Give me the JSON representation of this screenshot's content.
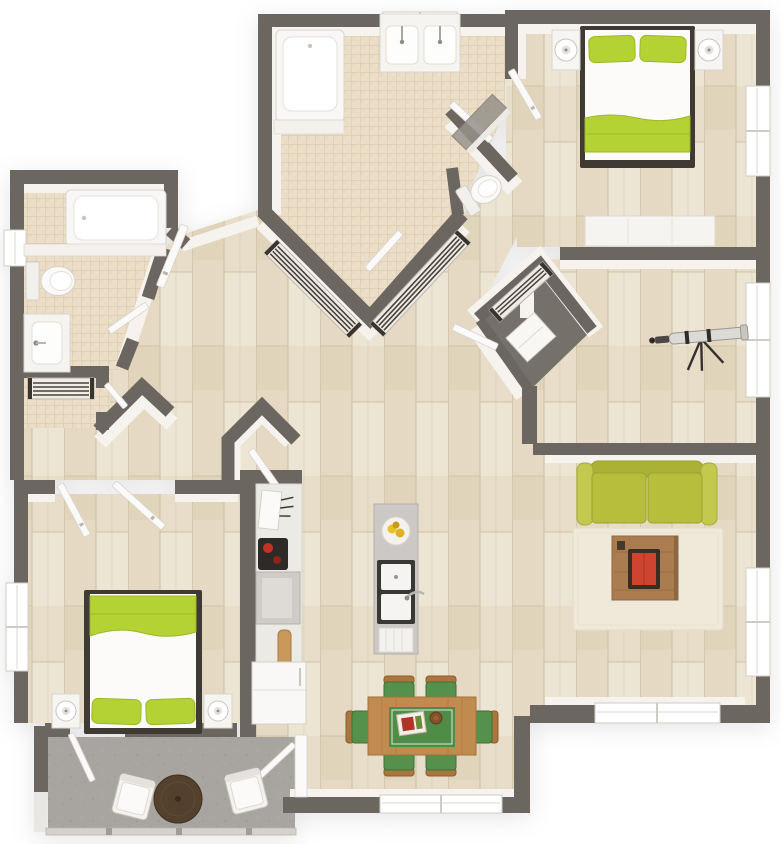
{
  "meta": {
    "description": "3D top-down floor plan of a two-bedroom two-bathroom apartment with open kitchen, dining area, living room, den with telescope, walk-in closets and a balcony patio"
  },
  "colors": {
    "background": "#ffffff",
    "wall": "#6c6660",
    "wall_face": "#f6f3ef",
    "wood_floor_base": "#e7ddc8",
    "tile_floor_base": "#ecdfca",
    "patio_floor": "#a8a49f",
    "closet_floor": "#76706a",
    "window_white": "#ffffff",
    "door_white": "#fbfaf8",
    "fixture_white": "#f8f7f5",
    "bed_green": "#b5d234",
    "sofa_green": "#b6be3c",
    "dining_chair_green": "#55914c",
    "table_runner_green": "#4f8c47",
    "dining_table_wood": "#c08b4f",
    "coffee_table_wood": "#aa7c50",
    "rug_cream": "#efe9da",
    "patio_table_brown": "#53402d",
    "accent_red": "#cf4430",
    "rod_dark": "#3a342e",
    "counter_grey": "#ccc8c5"
  },
  "scene": {
    "rooms": [
      {
        "name": "master-bathroom",
        "floor": "tile",
        "features": [
          "bathtub",
          "double-vanity",
          "toilet",
          "shower-panel"
        ]
      },
      {
        "name": "walk-in-closet",
        "floor": "tile",
        "features": [
          "two-hanging-rails"
        ]
      },
      {
        "name": "master-bedroom",
        "floor": "wood",
        "features": [
          "double-bed-green-linens",
          "two-nightstands-with-lamps",
          "dresser-bench",
          "windows"
        ]
      },
      {
        "name": "den",
        "floor": "wood",
        "features": [
          "telescope",
          "corner-closet-with-rail",
          "windows"
        ]
      },
      {
        "name": "living-room",
        "floor": "wood",
        "features": [
          "green-sofa",
          "area-rug",
          "coffee-table-with-red-book",
          "windows"
        ]
      },
      {
        "name": "kitchen",
        "floor": "wood",
        "features": [
          "island-with-double-sink",
          "fruit-plate",
          "dishwasher-front",
          "counter-run",
          "knife-block",
          "coffee-machine",
          "cooktop",
          "cutting-board",
          "refrigerator"
        ]
      },
      {
        "name": "dining-area",
        "floor": "wood",
        "features": [
          "wood-table-green-runner",
          "six-green-chairs",
          "serving-tray",
          "bowl",
          "windows"
        ]
      },
      {
        "name": "second-bathroom",
        "floor": "tile",
        "features": [
          "bathtub",
          "toilet",
          "vanity",
          "closet-with-rail"
        ]
      },
      {
        "name": "second-bedroom",
        "floor": "wood",
        "features": [
          "double-bed-green-linens",
          "two-nightstands-with-lamps",
          "double-doors",
          "window"
        ]
      },
      {
        "name": "balcony-patio",
        "floor": "concrete",
        "features": [
          "round-table",
          "two-chairs",
          "railing",
          "two-doors"
        ]
      }
    ]
  }
}
